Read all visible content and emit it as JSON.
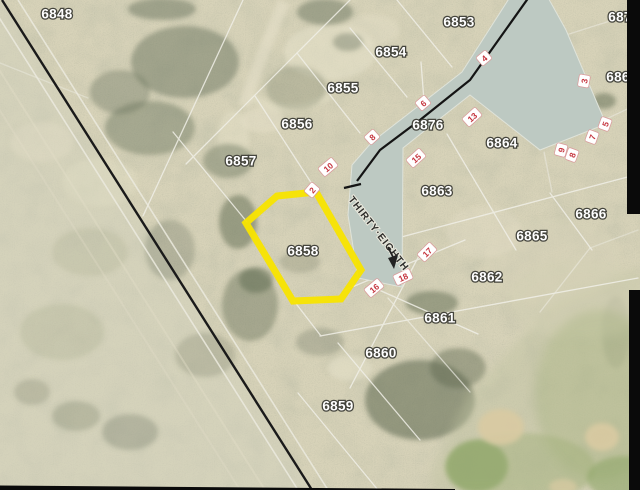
{
  "map": {
    "colors": {
      "terrain": "#d8d3b9",
      "road": "#bdc9c2",
      "highlight": "#f8e400",
      "marker": "#c5353f",
      "parcel_line": "#f0efe7"
    },
    "parcels": [
      {
        "id": "6848",
        "x": 57,
        "y": 14
      },
      {
        "id": "6853",
        "x": 459,
        "y": 22
      },
      {
        "id": "6854",
        "x": 391,
        "y": 52
      },
      {
        "id": "6855",
        "x": 343,
        "y": 88
      },
      {
        "id": "6856",
        "x": 297,
        "y": 124
      },
      {
        "id": "6857",
        "x": 241,
        "y": 161
      },
      {
        "id": "6876",
        "x": 428,
        "y": 125
      },
      {
        "id": "6864",
        "x": 502,
        "y": 143
      },
      {
        "id": "6863",
        "x": 437,
        "y": 191
      },
      {
        "id": "6866",
        "x": 591,
        "y": 214
      },
      {
        "id": "6865",
        "x": 532,
        "y": 236
      },
      {
        "id": "6862",
        "x": 487,
        "y": 277
      },
      {
        "id": "6861",
        "x": 440,
        "y": 318
      },
      {
        "id": "6860",
        "x": 381,
        "y": 353
      },
      {
        "id": "6859",
        "x": 338,
        "y": 406
      }
    ],
    "edge_parcels": [
      {
        "id": "687",
        "x": 620,
        "y": 17
      },
      {
        "id": "686",
        "x": 618,
        "y": 77
      }
    ],
    "highlighted_parcel": {
      "id": "6858",
      "x": 303,
      "y": 251,
      "outline_points": "277,196 316,192 361,270 341,299 293,301 246,223"
    },
    "street": {
      "name": "THIRTY·EIGHTH",
      "x": 350,
      "y": 198,
      "angle": 52
    },
    "road_markers": [
      {
        "label": "2",
        "x": 312,
        "y": 190,
        "angle": -50
      },
      {
        "label": "4",
        "x": 484,
        "y": 58,
        "angle": -40
      },
      {
        "label": "6",
        "x": 423,
        "y": 103,
        "angle": -40
      },
      {
        "label": "8",
        "x": 372,
        "y": 137,
        "angle": -42
      },
      {
        "label": "10",
        "x": 328,
        "y": 167,
        "angle": -40
      },
      {
        "label": "13",
        "x": 472,
        "y": 117,
        "angle": -42
      },
      {
        "label": "15",
        "x": 416,
        "y": 158,
        "angle": -42
      },
      {
        "label": "17",
        "x": 427,
        "y": 252,
        "angle": -45
      },
      {
        "label": "18",
        "x": 403,
        "y": 277,
        "angle": -25
      },
      {
        "label": "16",
        "x": 374,
        "y": 288,
        "angle": -40
      },
      {
        "label": "3",
        "x": 584,
        "y": 81,
        "angle": -80
      },
      {
        "label": "5",
        "x": 605,
        "y": 124,
        "angle": -70
      },
      {
        "label": "7",
        "x": 592,
        "y": 137,
        "angle": -70
      },
      {
        "label": "9",
        "x": 561,
        "y": 150,
        "angle": -75
      },
      {
        "label": "8",
        "x": 572,
        "y": 155,
        "angle": -70
      }
    ]
  }
}
